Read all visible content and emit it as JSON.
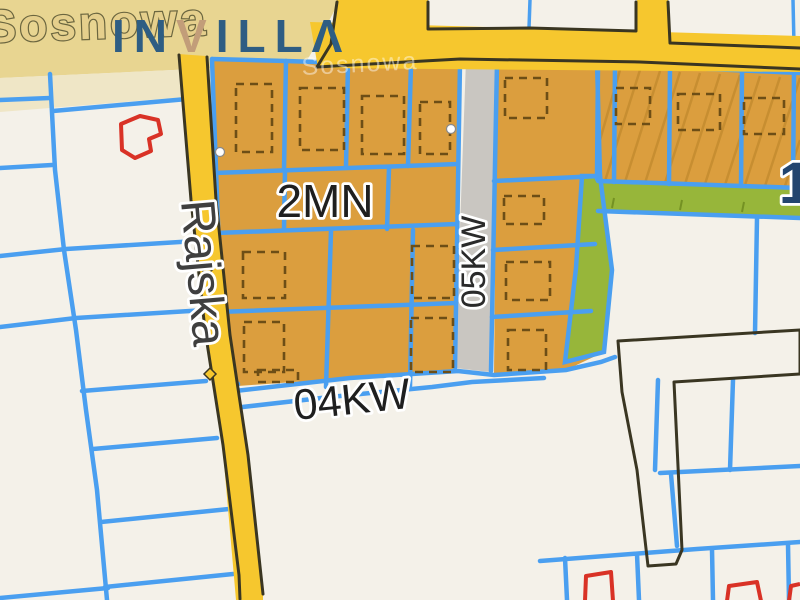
{
  "labels": {
    "sosnowa": "Sosnowa",
    "sosnowa_ghost": "Sosnowa",
    "rajska": "Rajska",
    "zone": "2MN",
    "road04": "04KW",
    "road05": "05KW",
    "partial_right": "1"
  },
  "watermark": {
    "p1": "IN",
    "p2": "V",
    "p3": "ILL",
    "p4": "Λ"
  },
  "colors": {
    "bg": "#f4f1e9",
    "road-yellow": "#f6c72e",
    "road-pale": "#e8d591",
    "road-pale2": "#efe6c6",
    "road-edge": "#3a3622",
    "parcel-orange": "#db9e3e",
    "parcel-green": "#97b63a",
    "strip-gray": "#c9c6c1",
    "line-blue": "#4a9ff0",
    "outline-red": "#d93226",
    "label-dark": "#1f1f1f",
    "label-navy": "#23456f",
    "watermark-navy": "#2e5d83",
    "watermark-tan": "#c29d79",
    "street-fill": "#e5cf8c",
    "street-stroke": "#6b663f"
  }
}
